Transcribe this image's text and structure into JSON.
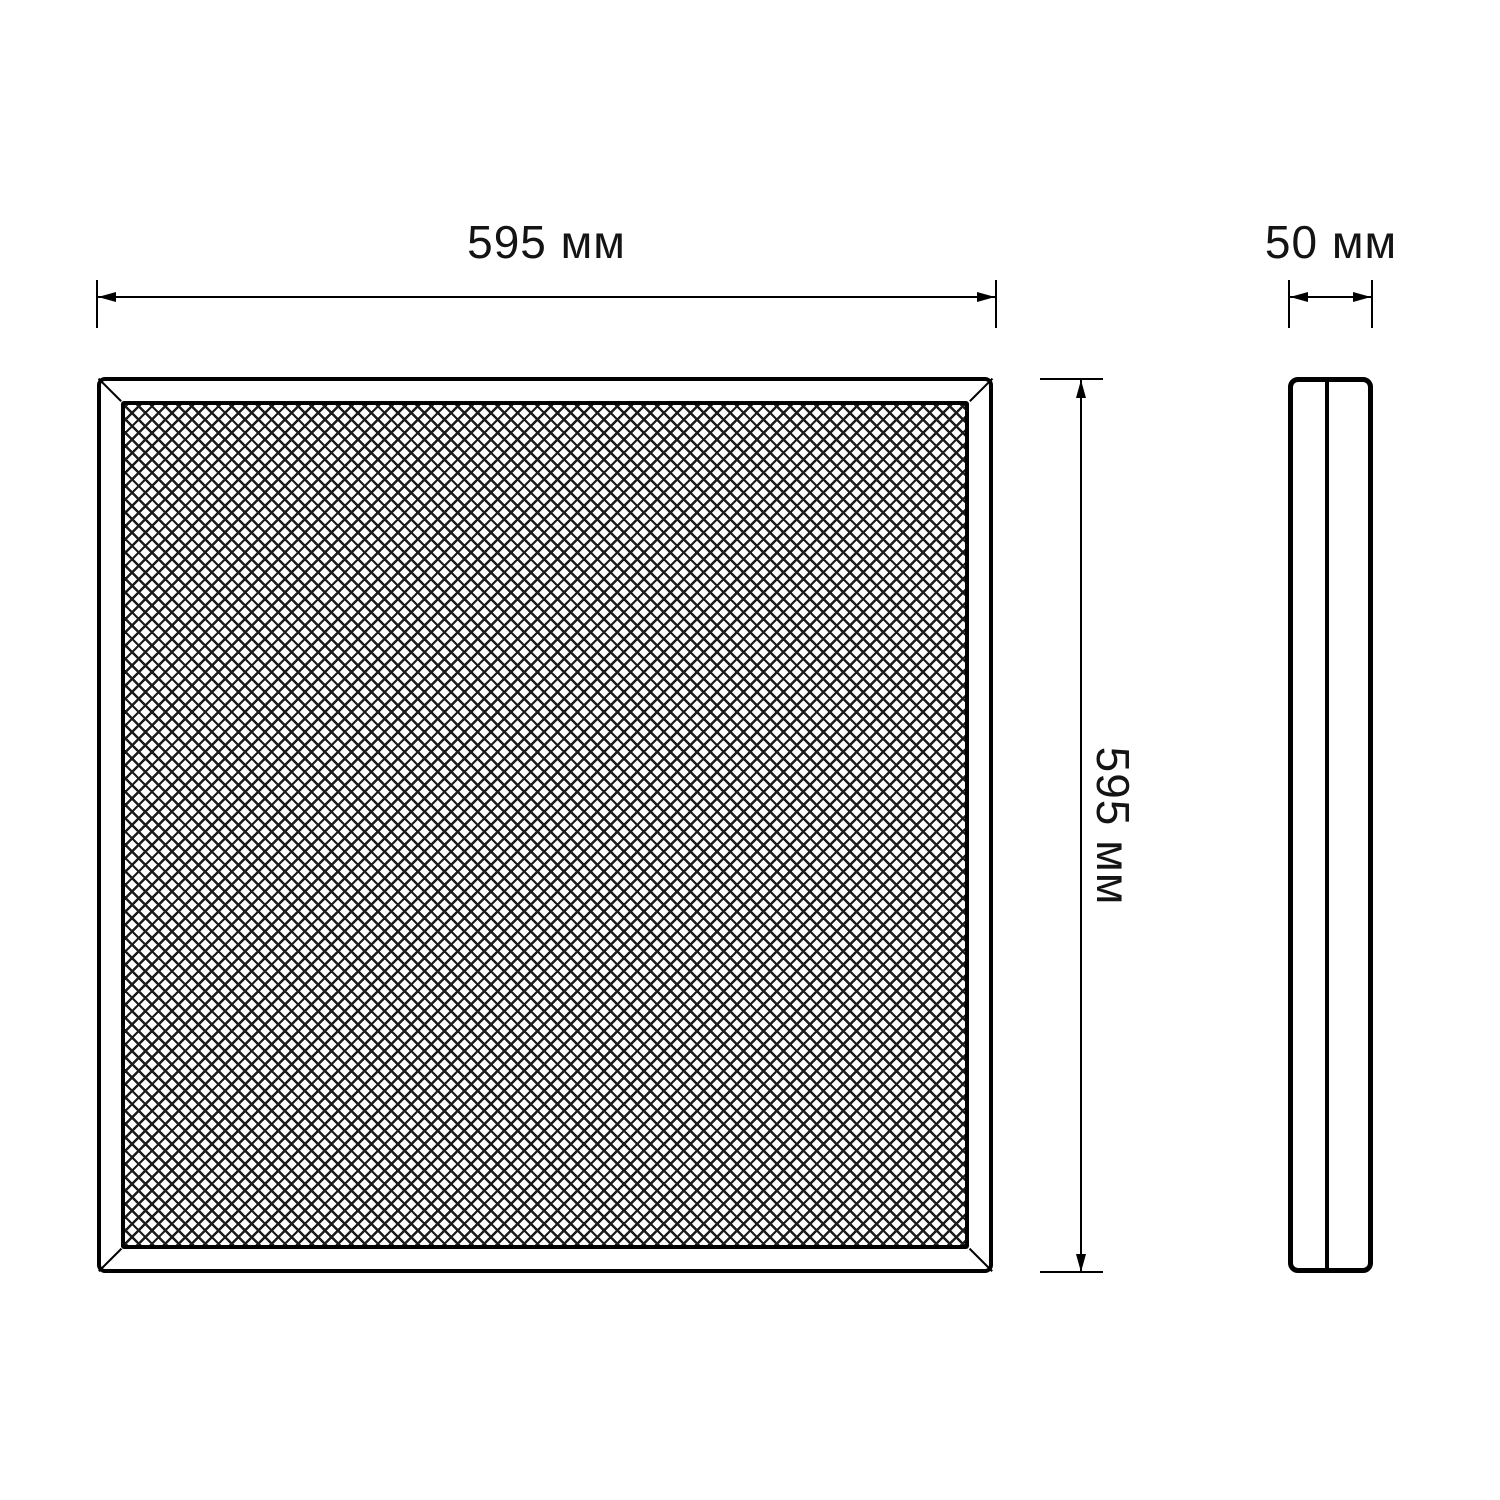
{
  "colors": {
    "background": "#ffffff",
    "line": "#000000",
    "text": "#141414"
  },
  "drawing": {
    "type": "technical-dimension-drawing",
    "views": [
      "front",
      "side-profile"
    ]
  },
  "dimensions": {
    "width": {
      "label": "595 мм"
    },
    "height": {
      "label": "595 мм"
    },
    "depth": {
      "label": "50 мм"
    }
  }
}
